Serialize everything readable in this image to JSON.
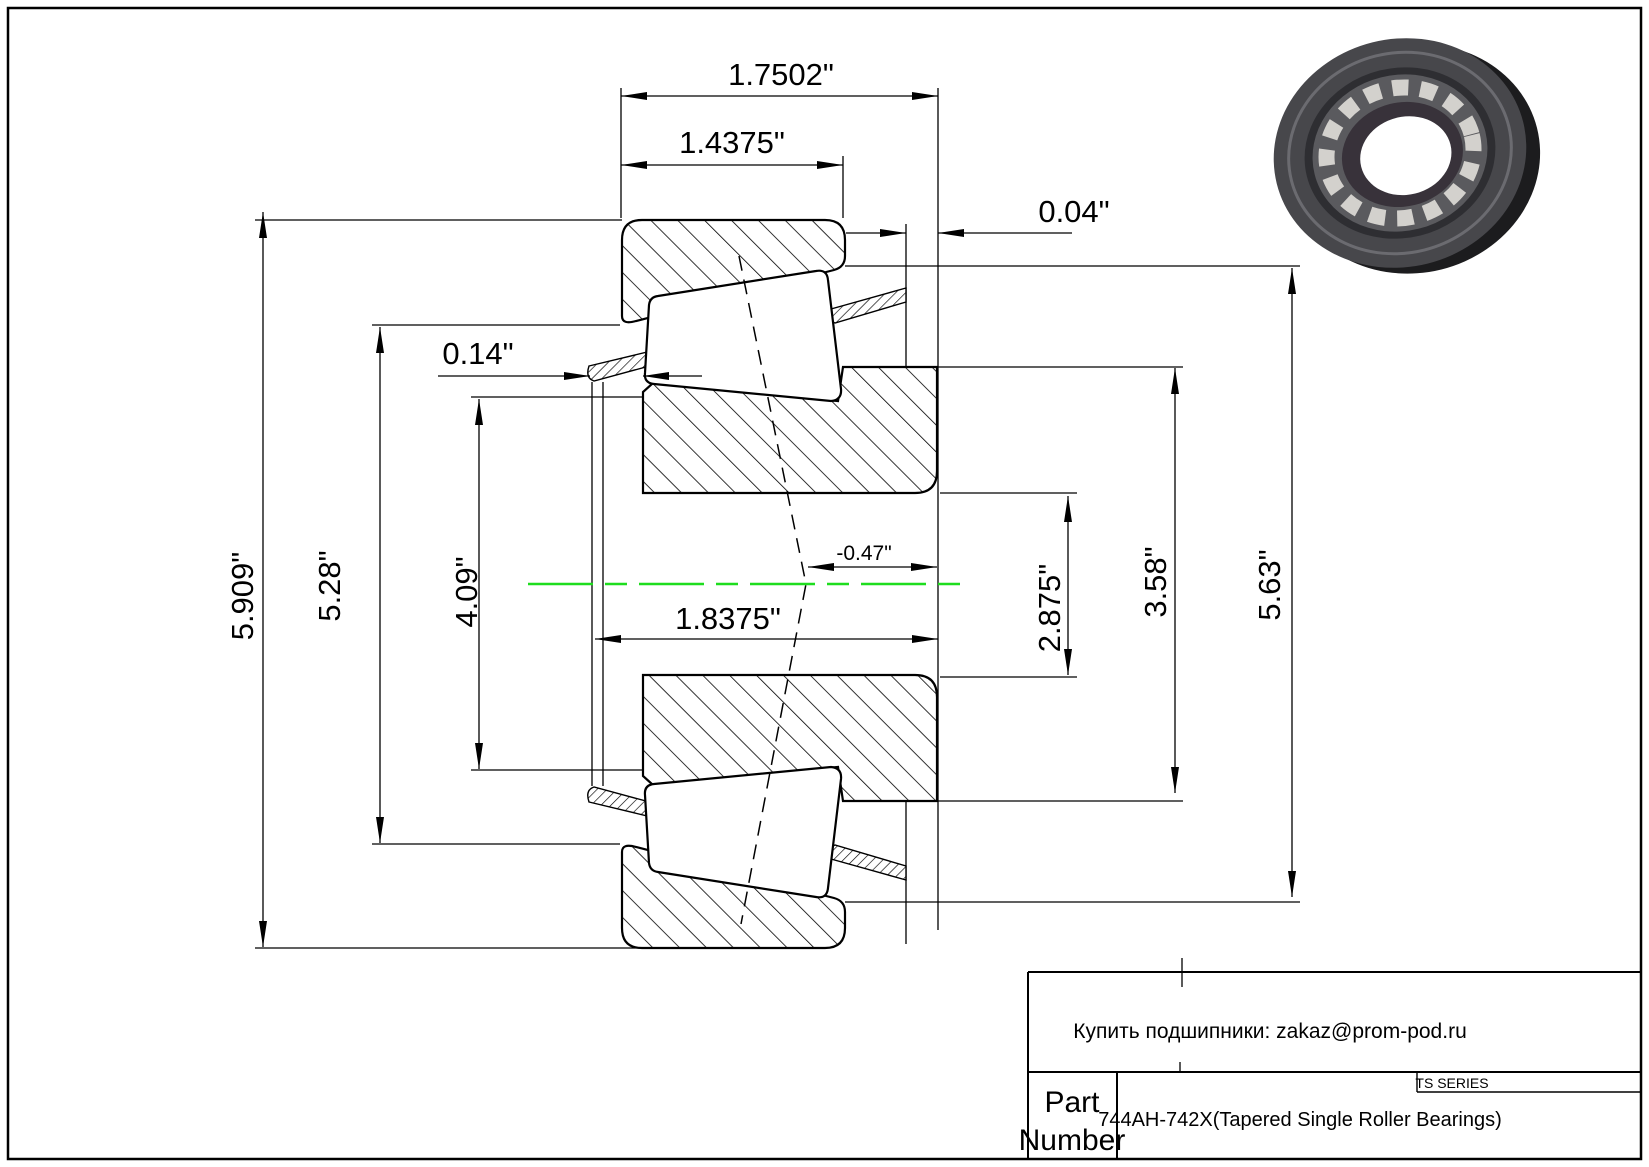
{
  "drawing": {
    "dim_labels": {
      "total_width": "1.7502\"",
      "cup_width": "1.4375\"",
      "right_standout": "0.04\"",
      "left_standout": "0.14\"",
      "cone_width": "1.8375\"",
      "effective_center": "-0.47\"",
      "outer_diameter": "5.909\"",
      "left_shoulder_diameter": "5.28\"",
      "backface_rib_diameter": "4.09\"",
      "bore_diameter": "2.875\"",
      "front_rib_diameter": "3.58\"",
      "cup_front_diameter": "5.63\""
    },
    "centerline_color": "#1edd1e"
  },
  "title_block": {
    "note": "Купить подшипники: zakaz@prom-pod.ru",
    "series_label": "TS SERIES",
    "part_label_line1": "Part",
    "part_label_line2": "Number",
    "part_number": "744AH-742X(Tapered Single Roller Bearings)"
  }
}
